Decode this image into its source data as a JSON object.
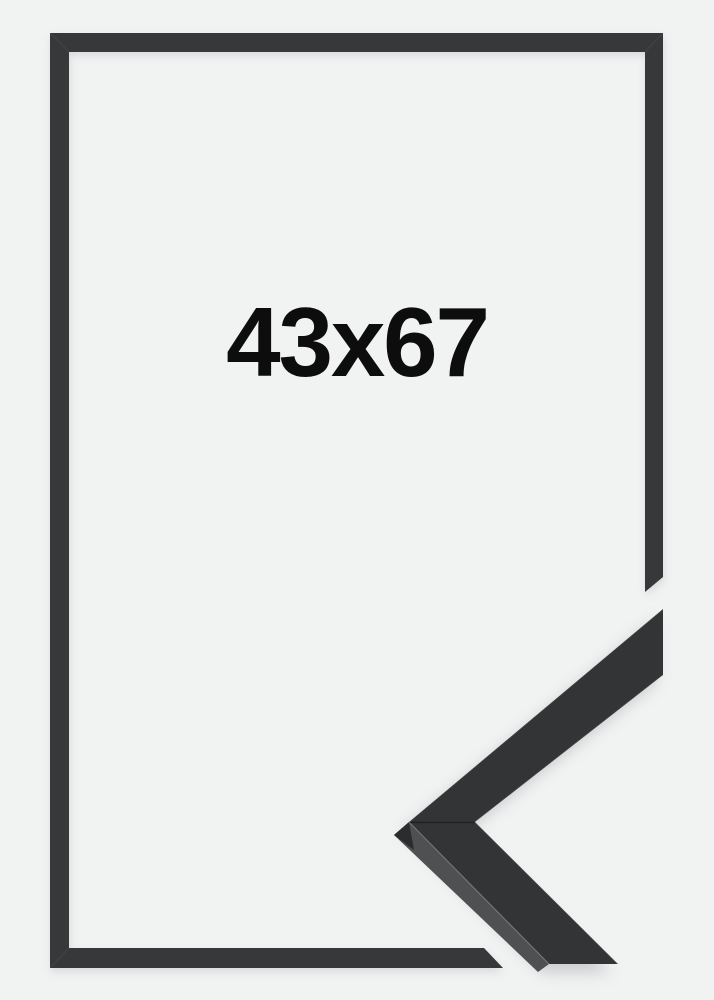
{
  "label": {
    "text": "43x67"
  },
  "colors": {
    "background": "#f1f2f2",
    "frame": "#36383a",
    "corner_sample_face": "#323436",
    "corner_sample_side": "#4e5052",
    "label_text": "#0d0d0d"
  }
}
